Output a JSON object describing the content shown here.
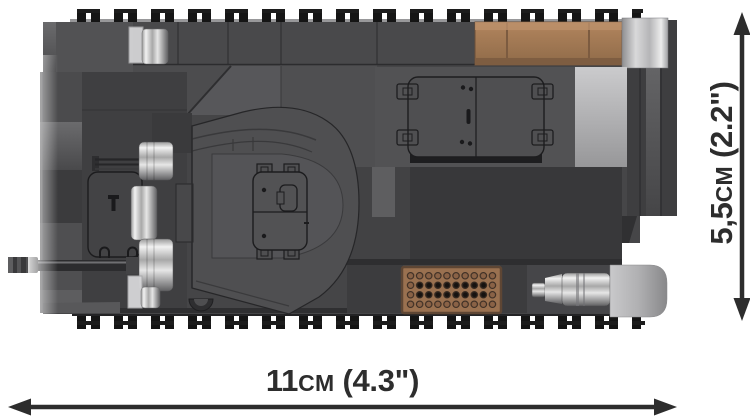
{
  "dimensions": {
    "length": {
      "metric_value": "11",
      "metric_unit": "cm",
      "imperial": "(4.3\")"
    },
    "width": {
      "metric_value": "5,5",
      "metric_unit": "cm",
      "imperial": "(2.2\")"
    }
  },
  "illustration": {
    "subject": "brick-tank-top-view",
    "colors": {
      "background": "#ffffff",
      "hull_gray": "#4a4a4c",
      "hull_dark": "#39393b",
      "track_black": "#151515",
      "crate_brown": "#a97e58",
      "grille_brown": "#9a7150",
      "chrome_silver": "#d9d9db",
      "dimension_text": "#2d2d2d"
    }
  }
}
